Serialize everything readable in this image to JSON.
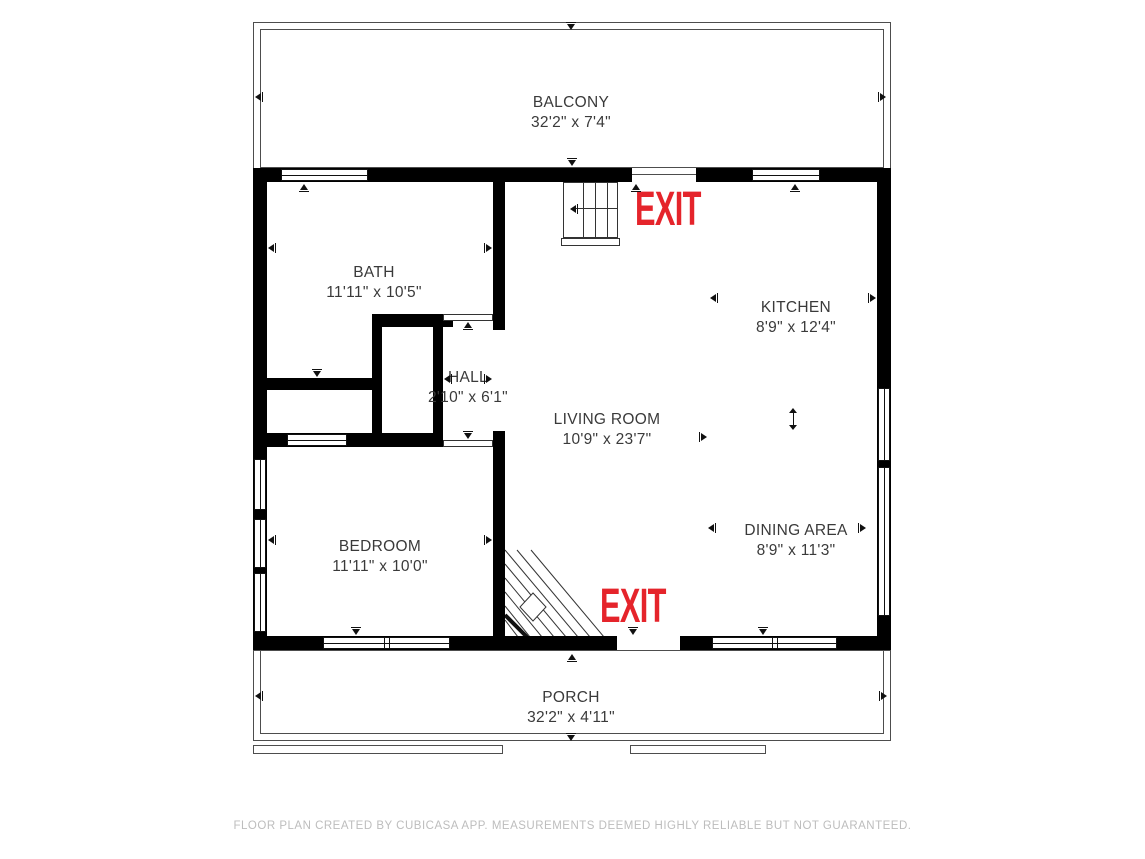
{
  "rooms": {
    "balcony": {
      "name": "BALCONY",
      "dims": "32'2\" x 7'4\""
    },
    "bath": {
      "name": "BATH",
      "dims": "11'11\" x 10'5\""
    },
    "hall": {
      "name": "HALL",
      "dims": "2'10\" x 6'1\""
    },
    "kitchen": {
      "name": "KITCHEN",
      "dims": "8'9\" x 12'4\""
    },
    "living": {
      "name": "LIVING ROOM",
      "dims": "10'9\" x 23'7\""
    },
    "dining": {
      "name": "DINING AREA",
      "dims": "8'9\" x 11'3\""
    },
    "bedroom": {
      "name": "BEDROOM",
      "dims": "11'11\" x 10'0\""
    },
    "porch": {
      "name": "PORCH",
      "dims": "32'2\" x 4'11\""
    }
  },
  "exits": {
    "top": "EXIT",
    "bottom": "EXIT"
  },
  "footer": "FLOOR PLAN CREATED BY CUBICASA APP. MEASUREMENTS DEEMED HIGHLY RELIABLE BUT NOT GUARANTEED.",
  "colors": {
    "exit_red": "#e5242b",
    "wall_black": "#000000",
    "label_gray": "#3a3a3a",
    "footer_gray": "#bdbdbd"
  }
}
